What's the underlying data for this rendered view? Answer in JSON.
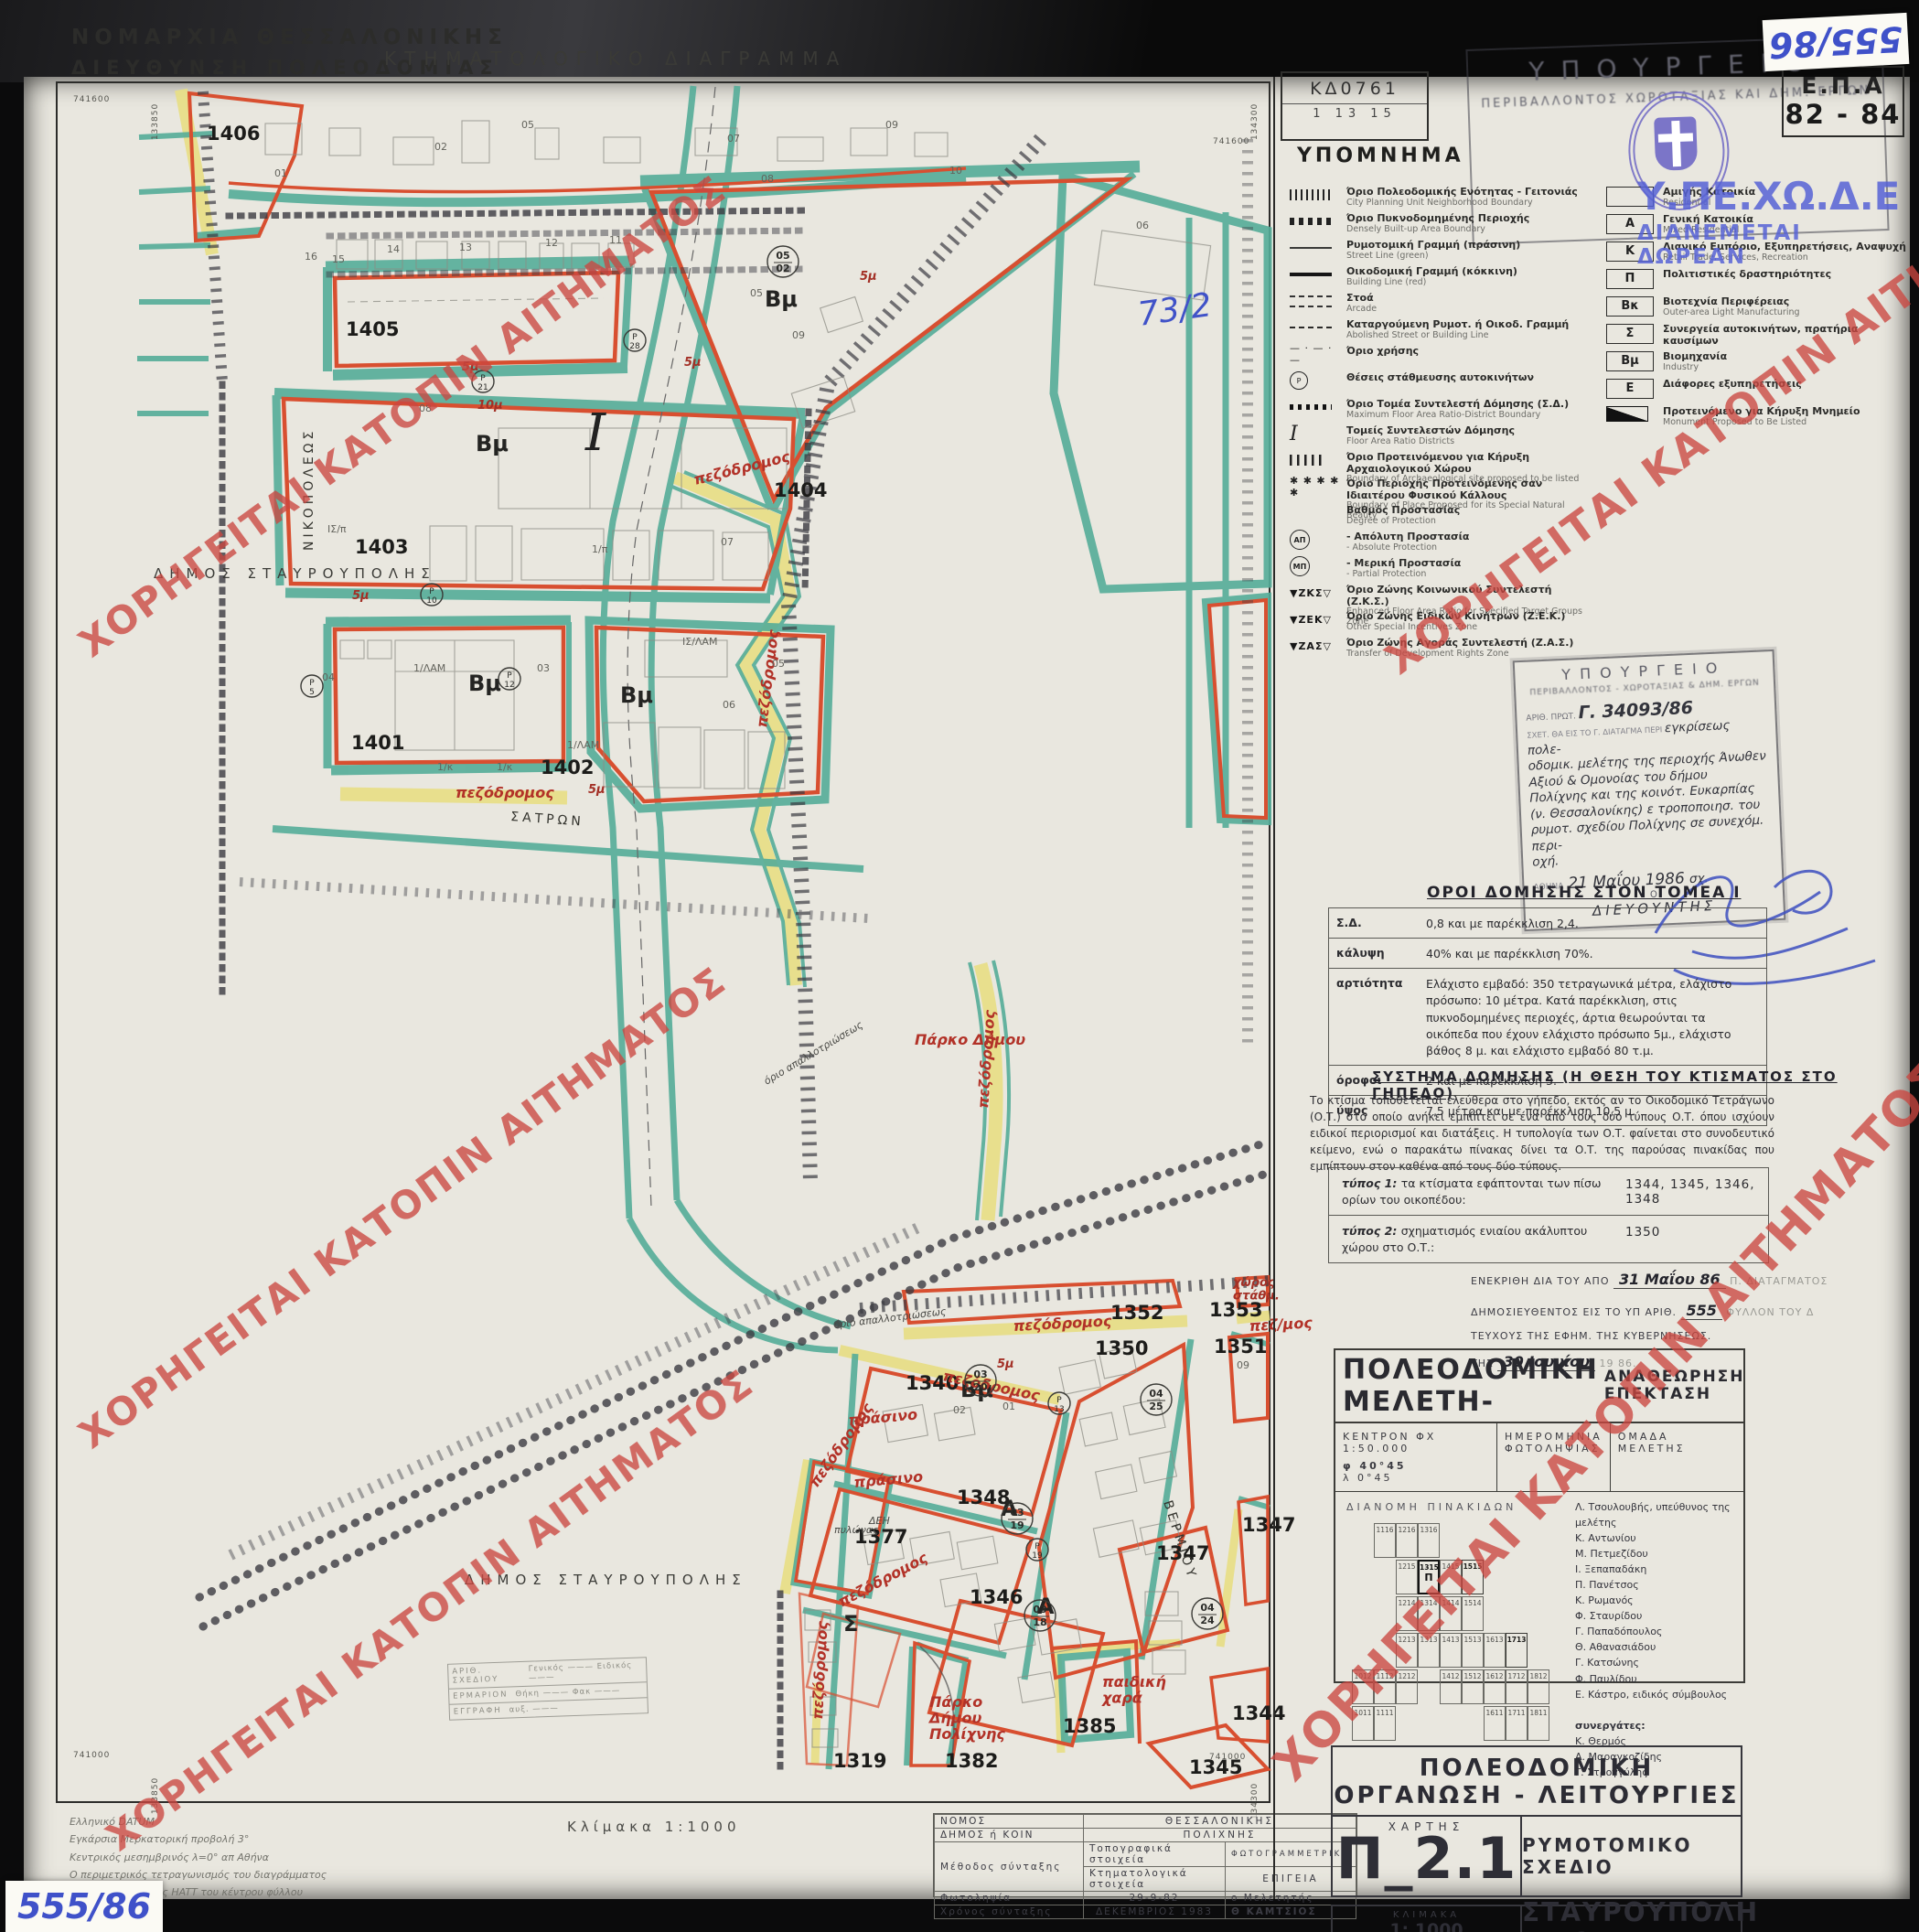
{
  "watermark": {
    "text": "ΧΟΡΗΓΕΙΤΑΙ ΚΑΤΟΠΙΝ ΑΙΤΗΜΑΤΟΣ",
    "color": "#ca4640"
  },
  "header": {
    "org_line1": "ΝΟΜΑΡΧΙΑ ΘΕΣΣΑΛΟΝΙΚΗΣ",
    "org_line2": "ΔΙΕΥΘΥΝΣΗ ΠΟΛΕΟΔΟΜΙΑΣ",
    "title": "ΚΤΗΜΑΤΟΛΟΓΙΚΟ ΔΙΑΓΡΑΜΜΑ",
    "sheet_code": "ΚΔ0761",
    "sheet_index": "1 13 15"
  },
  "stamps": {
    "ministry": {
      "l1": "ΥΠΟΥΡΓΕΙΟ",
      "l2": "ΠΕΡΙΒΑΛΛΟΝΤΟΣ   ΧΩΡΟΤΑΞΙΑΣ   ΚΑΙ   ΔΗΜ.   ΕΡΓΩΝ"
    },
    "overprint1": "Υ.ΠΕ.ΧΩ.Δ.Ε",
    "overprint2": "ΔΙΑΝΕΜΕΤΑΙ ΔΩΡΕΑΝ",
    "epa1": "Ε.Π.Α",
    "epa2": "82 - 84",
    "sticker_top": "555/86",
    "sticker_bottom": "555/86",
    "note_blue": "73/2"
  },
  "approval_stamp": {
    "l1": "ΥΠΟΥΡΓΕΙΟ",
    "l2": "ΠΕΡΙΒΑΛΛΟΝΤΟΣ - ΧΩΡΟΤΑΞΙΑΣ & ΔΗΜ. ΕΡΓΩΝ",
    "prot_label": "ΑΡΙΘ. ΠΡΩΤ.",
    "prot_num": "Γ. 34093/86",
    "rel_line": "ΣΧΕΤ. ΘΑ ΕΙΣ ΤΟ Γ. ΔΙΑΤΑΓΜΑ ΠΕΡΙ",
    "hw_inline": "εγκρίσεως πολε-",
    "hw_lines": [
      "οδομικ. μελέτης της περιοχής Άνωθεν",
      "Αξιού & Ομονοίας του δήμου",
      "Πολίχνης και της κοινότ. Ευκαρπίας",
      "(ν. Θεσσαλονίκης) ε τροποποιησ. του",
      "ρυμοτ. σχεδίου Πολίχνης σε συνεχόμ. περι-",
      "οχή."
    ],
    "city": "ΑΘΗΝΑ",
    "date": "21 Μαΐου 1986",
    "date_suffix": "σχ.",
    "o": "Ο",
    "role": "ΔΙΕΥΘΥΝΤΗΣ"
  },
  "legend": {
    "title": "ΥΠΟΜΝΗΜΑ",
    "items": [
      {
        "sym": "hatch",
        "el": "Όριο Πολεοδομικής Ενότητας - Γειτονιάς",
        "en": "City Planning Unit Neighborhood Boundary"
      },
      {
        "sym": "dotsq",
        "el": "Όριο Πυκνοδομημένης Περιοχής",
        "en": "Densely Built-up Area Boundary"
      },
      {
        "sym": "thin",
        "el": "Ρυμοτομική Γραμμή (πράσινη)",
        "en": "Street Line (green)"
      },
      {
        "sym": "thick",
        "el": "Οικοδομική Γραμμή (κόκκινη)",
        "en": "Building Line (red)"
      },
      {
        "sym": "arcade",
        "el": "Στοά",
        "en": "Arcade"
      },
      {
        "sym": "dashed",
        "el": "Καταργούμενη Ρυμοτ. ή Οικοδ. Γραμμή",
        "en": "Abolished Street or Building Line"
      },
      {
        "sym": "glyph",
        "glyph": "— · — · —",
        "el": "Όριο  χρήσης",
        "en": ""
      },
      {
        "sym": "circ",
        "glyph": "Ρ",
        "el": "Θέσεις στάθμευσης αυτοκινήτων",
        "en": ""
      },
      {
        "sym": "dots",
        "el": "Όριο Τομέα Συντελεστή Δόμησης (Σ.Δ.)",
        "en": "Maximum Floor Area Ratio-District Boundary"
      },
      {
        "sym": "roman",
        "glyph": "I",
        "el": "Τομείς Συντελεστών Δόμησης",
        "en": "Floor Area Ratio Districts"
      },
      {
        "sym": "vbars",
        "el": "Όριο Προτεινόμενου για Κήρυξη Αρχαιολογικού Χώρου",
        "en": "Boundary of Archaeological site proposed to be listed"
      },
      {
        "sym": "glyph",
        "glyph": "✱ ✱ ✱ ✱ ✱",
        "el": "Όριο Περιοχής Προτεινόμενης σαν Ιδιαιτέρου Φυσικού Κάλλους",
        "en": "Boundary of Place Proposed for its Special Natural Beauty"
      },
      {
        "sym": "none",
        "el": "Βαθμός Προστασίας",
        "en": "Degree of Protection"
      },
      {
        "sym": "badge",
        "glyph": "ΑΠ",
        "el": "-  Απόλυτη Προστασία",
        "en": "-  Absolute Protection"
      },
      {
        "sym": "badge",
        "glyph": "ΜΠ",
        "el": "-  Μερική Προστασία",
        "en": "-  Partial Protection"
      },
      {
        "sym": "zone",
        "glyph": "▼ΖΚΣ▽",
        "el": "Όριο Ζώνης Κοινωνικού Συντελεστή (Ζ.Κ.Σ.)",
        "en": "Enhanced Floor Area Ratio for Specified Target Groups Zone"
      },
      {
        "sym": "zone",
        "glyph": "▼ΖΕΚ▽",
        "el": "Όριο Ζώνης Ειδικών Κινήτρων (Ζ.Ε.Κ.)",
        "en": "Other Special Incentives Zone"
      },
      {
        "sym": "zone",
        "glyph": "▼ΖΑΣ▽",
        "el": "Όριο Ζώνης Αγοράς Συντελεστή (Ζ.Α.Σ.)",
        "en": "Transfer of Development Rights Zone"
      }
    ],
    "uses": [
      {
        "code": "",
        "el": "Αμιγής Κατοικία",
        "en": "Residential"
      },
      {
        "code": "Α",
        "el": "Γενική Κατοικία",
        "en": "Mixed Residential"
      },
      {
        "code": "Κ",
        "el": "Λιανικό Εμπόριο, Εξυπηρετήσεις, Αναψυχή",
        "en": "Retail Trade, Services, Recreation"
      },
      {
        "code": "Π",
        "el": "Πολιτιστικές δραστηριότητες",
        "en": ""
      },
      {
        "code": "Βκ",
        "el": "Βιοτεχνία Περιφέρειας",
        "en": "Outer-area Light Manufacturing"
      },
      {
        "code": "Σ",
        "el": "Συνεργεία αυτοκινήτων, πρατήρια καυσίμων",
        "en": ""
      },
      {
        "code": "Βμ",
        "el": "Βιομηχανία",
        "en": "Industry"
      },
      {
        "code": "Ε",
        "el": "Διάφορες εξυπηρετήσεις",
        "en": ""
      },
      {
        "code": "MONO",
        "el": "Προτεινόμενο για Κήρυξη Μνημείο",
        "en": "Monument Proposed to Be Listed"
      }
    ]
  },
  "terms": {
    "title": "ΟΡΟΙ ΔΟΜΗΣΗΣ ΣΤΟΝ ΤΟΜΕΑ Ι",
    "rows": [
      {
        "label": "Σ.Δ.",
        "value": "0,8 και με παρέκκλιση 2,4."
      },
      {
        "label": "κάλυψη",
        "value": "40% και με παρέκκλιση 70%."
      },
      {
        "label": "αρτιότητα",
        "value": "Ελάχιστο εμβαδό: 350 τετραγωνικά μέτρα, ελάχιστο πρόσωπο: 10 μέτρα.  Κατά παρέκκλιση, στις πυκνοδομημένες περιοχές, άρτια θεωρούνται τα οικόπεδα που έχουν ελάχιστο πρόσωπο 5μ., ελάχιστο βάθος 8 μ. και ελάχιστο εμβαδό 80 τ.μ."
      },
      {
        "label": "όροφοι",
        "value": "2 και με παρέκκλιση 3."
      },
      {
        "label": "ύψος",
        "value": "7,5 μέτρα και με παρέκκλιση 10,5 μ."
      }
    ]
  },
  "system": {
    "title": "ΣΥΣΤΗΜΑ ΔΟΜΗΣΗΣ (Η ΘΕΣΗ ΤΟΥ ΚΤΙΣΜΑΤΟΣ ΣΤΟ ΓΗΠΕΔΟ)",
    "paragraph": "Το κτίσμα τοποθετείται ελεύθερα στο γήπεδο, εκτός αν το Οικοδομικό Τετράγωνο (Ο.Τ.) στο οποίο ανήκει εμπίπτει σε ένα από τους δύο τύπους Ο.Τ. όπου ισχύουν ειδικοί περιορισμοί και διατάξεις.  Η τυπολογία των Ο.Τ. φαίνεται στο συνοδευτικό κείμενο, ενώ ο παρακάτω πίνακας δίνει τα Ο.Τ. της παρούσας πινακίδας που εμπίπτουν στον καθένα από τους δύο τύπους.",
    "types": [
      {
        "label": "τύπος 1:",
        "desc": "τα κτίσματα εφάπτονται των πίσω ορίων του οικοπέδου:",
        "blocks": "1344, 1345, 1346, 1348"
      },
      {
        "label": "τύπος 2:",
        "desc": "σχηματισμός ενιαίου ακάλυπτου χώρου στο Ο.Τ.:",
        "blocks": "1350"
      }
    ]
  },
  "gazette": {
    "lines": [
      {
        "p": "ΕΝΕΚΡΙΘΗ ΔΙΑ ΤΟΥ ΑΠΟ",
        "h": "31 Μαΐου 86",
        "f": "Π. ΔΙΑΤΑΓΜΑΤΟΣ"
      },
      {
        "p": "ΔΗΜΟΣΙΕΥΘΕΝΤΟΣ ΕΙΣ ΤΟ ΥΠ ΑΡΙΘ.",
        "h": "555",
        "f": "ΦΥΛΛΟΝ ΤΟΥ Δ"
      },
      {
        "p": "ΤΕΥΧΟΥΣ ΤΗΣ ΕΦΗΜ. ΤΗΣ ΚΥΒΕΡΝΗΣΕΩΣ.",
        "h": "",
        "f": ""
      },
      {
        "p": "ΤΗΣ",
        "h": "30 Ιουνίου",
        "f": "19 86."
      }
    ]
  },
  "study": {
    "title_main": "ΠΟΛΕΟΔΟΜΙΚΗ ΜΕΛΕΤΗ-",
    "title_sub1": "ΑΝΑΘΕΩΡΗΣΗ",
    "title_sub2": "ΕΠΕΚΤΑΣΗ",
    "kentron_l1": "ΚΕΝΤΡΟΝ ΦΧ 1:50.000",
    "kentron_l2": "φ  40°45",
    "kentron_l3": "λ   0°45",
    "photo_l1": "ΗΜΕΡΟΜΗΝΙΑ",
    "photo_l2": "ΦΩΤΟΛΗΨΙΑΣ",
    "team_title": "ΟΜΑΔΑ  ΜΕΛΕΤΗΣ",
    "team": [
      "Λ. Τσουλουβής, υπεύθυνος της μελέτης",
      "Κ. Αντωνίου",
      "Μ. Πετμεζίδου",
      "Ι. Ξεπαπαδάκη",
      "Π. Πανέτσος",
      "Κ. Ρωμανός",
      "Φ. Σταυρίδου",
      "Γ. Παπαδόπουλος",
      "Θ. Αθανασιάδου",
      "Γ. Κατσώνης",
      "Φ. Παυλίδου",
      "Ε. Κάστρο, ειδικός σύμβουλος"
    ],
    "collab_title": "συνεργάτες:",
    "collaborators": [
      "Κ. Θερμός",
      "Α. Μαραγκοζίδης",
      "Γ. Στρογγύλης"
    ],
    "grid_title": "ΔΙΑΝΟΜΗ  ΠΙΝΑΚΙΔΩΝ",
    "grid_cells": [
      {
        "n": "1116",
        "c": 1,
        "r": 0
      },
      {
        "n": "1216",
        "c": 2,
        "r": 0
      },
      {
        "n": "1316",
        "c": 3,
        "r": 0
      },
      {
        "n": "1215",
        "c": 2,
        "r": 1
      },
      {
        "n": "1315",
        "c": 3,
        "r": 1,
        "cur": true,
        "sub": "Π"
      },
      {
        "n": "1415",
        "c": 4,
        "r": 1
      },
      {
        "n": "1515",
        "c": 5,
        "r": 1,
        "b": true
      },
      {
        "n": "1214",
        "c": 2,
        "r": 2
      },
      {
        "n": "1314",
        "c": 3,
        "r": 2
      },
      {
        "n": "1414",
        "c": 4,
        "r": 2
      },
      {
        "n": "1514",
        "c": 5,
        "r": 2
      },
      {
        "n": "1213",
        "c": 2,
        "r": 3
      },
      {
        "n": "1313",
        "c": 3,
        "r": 3
      },
      {
        "n": "1413",
        "c": 4,
        "r": 3
      },
      {
        "n": "1513",
        "c": 5,
        "r": 3
      },
      {
        "n": "1613",
        "c": 6,
        "r": 3
      },
      {
        "n": "1713",
        "c": 7,
        "r": 3,
        "b": true
      },
      {
        "n": "1012",
        "c": 0,
        "r": 4
      },
      {
        "n": "1112",
        "c": 1,
        "r": 4
      },
      {
        "n": "1212",
        "c": 2,
        "r": 4
      },
      {
        "n": "1412",
        "c": 4,
        "r": 4
      },
      {
        "n": "1512",
        "c": 5,
        "r": 4
      },
      {
        "n": "1612",
        "c": 6,
        "r": 4
      },
      {
        "n": "1712",
        "c": 7,
        "r": 4
      },
      {
        "n": "1812",
        "c": 8,
        "r": 4
      },
      {
        "n": "1011",
        "c": 0,
        "r": 5
      },
      {
        "n": "1111",
        "c": 1,
        "r": 5
      },
      {
        "n": "1611",
        "c": 6,
        "r": 5
      },
      {
        "n": "1711",
        "c": 7,
        "r": 5
      },
      {
        "n": "1811",
        "c": 8,
        "r": 5
      }
    ]
  },
  "org": {
    "title": "ΠΟΛΕΟΔΟΜΙΚΗ  ΟΡΓΑΝΩΣΗ - ΛΕΙΤΟΥΡΓΙΕΣ",
    "chart_label": "ΧΑΡΤΗΣ",
    "chart_code": "Π_2.1",
    "map_type": "ΡΥΜΟΤΟΜΙΚΟ ΣΧΕΔΙΟ",
    "scale_label": "ΚΛΙΜΑΚΑ",
    "scale": "1: 1000",
    "date": "ΓΕΝΑΡΗΣ 1986",
    "area": "ΣΤΑΥΡΟΥΠΟΛΗ – ΠΟΛΙΧΝΗ",
    "nomos_label": "ΝΟΜΟΣ",
    "nomos": "ΘΕΣΣΑΛΟΝΙΚΗΣ"
  },
  "title_block": {
    "nomos_label": "ΝΟΜΟΣ",
    "nomos": "ΘΕΣΣΑΛΟΝΙΚΗΣ",
    "dimos_label": "ΔΗΜΟΣ ή ΚΟΙΝ",
    "dimos": "ΠΟΛΙΧΝΗΣ",
    "method_label": "Μέθοδος σύνταξης",
    "topo_label": "Τοπογραφικά στοιχεία",
    "topo": "ΦΩΤΟΓΡΑΜΜΕΤΡΙΚΑ",
    "ktim_label": "Κτηματολογικά στοιχεία",
    "ktim": "ΕΠΙΓΕΙΑ",
    "photo_label": "Φωτοληψία",
    "photo": "29-9-82",
    "meletitis_label": "ο Μελετητής",
    "time_label": "Χρόνος σύνταξης",
    "time": "ΔΕΚΕΜΒΡΙΟΣ 1983",
    "meletitis": "Θ ΚΑΜΤΣΙΟΣ"
  },
  "datum_notes": [
    "Ελληνικό DATUM",
    "Εγκάρσια Μερκατορική προβολή 3°",
    "Κεντρικός μεσημβρινός λ=0° απ Αθήνα",
    "Ο περιμετρικός τετραγωνισμός του διαγράμματος",
    "είναι της προβολής HATT του κέντρου φύλλου",
    "απ Αθήνα"
  ],
  "scale_note": "Κλίμακα  1:1000",
  "archive": {
    "r1l": "ΑΡΙΘ. ΣΧΕΔΙΟΥ",
    "r1v": "Γενικός ———   Ειδικός ———",
    "r2l": "ΕΡΜΑΡΙΟΝ",
    "r2v": "Θήκη ———   Φακ ———",
    "r3l": "ΕΓΓΡΑΦΗ",
    "r3v": "αυξ. ———"
  },
  "map": {
    "corners": {
      "tl_e": "741600",
      "tl_n": "133850",
      "tr_e": "741600",
      "tr_n": "134300",
      "bl_e": "741000",
      "bl_n": "133850",
      "br_e": "741000",
      "br_n": "134300"
    },
    "labels": [
      [
        "1406",
        226,
        153,
        "bn"
      ],
      [
        "1405",
        378,
        367,
        "bn"
      ],
      [
        "1403",
        388,
        605,
        "bn"
      ],
      [
        "1401",
        384,
        819,
        "bn"
      ],
      [
        "1402",
        591,
        846,
        "bn"
      ],
      [
        "1404",
        846,
        543,
        "bn"
      ],
      [
        "1340",
        990,
        1519,
        "bn"
      ],
      [
        "1350",
        1197,
        1481,
        "bn"
      ],
      [
        "1351",
        1327,
        1479,
        "bn"
      ],
      [
        "1352",
        1214,
        1442,
        "bn"
      ],
      [
        "1353",
        1322,
        1439,
        "bn"
      ],
      [
        "1348",
        1046,
        1644,
        "bn"
      ],
      [
        "1377",
        934,
        1687,
        "bn"
      ],
      [
        "1346",
        1060,
        1753,
        "bn"
      ],
      [
        "1347",
        1264,
        1705,
        "bn"
      ],
      [
        "1347",
        1358,
        1674,
        "bn"
      ],
      [
        "1319",
        911,
        1932,
        "bn"
      ],
      [
        "1382",
        1033,
        1932,
        "bn"
      ],
      [
        "1385",
        1162,
        1894,
        "bn"
      ],
      [
        "1345",
        1300,
        1939,
        "bn"
      ],
      [
        "1344",
        1347,
        1880,
        "bn"
      ],
      [
        "Βμ",
        520,
        493,
        "zn"
      ],
      [
        "Βμ",
        512,
        755,
        "zn"
      ],
      [
        "Βμ",
        678,
        768,
        "zn"
      ],
      [
        "Βμ",
        836,
        335,
        "zn"
      ],
      [
        "Βμ",
        1050,
        1527,
        "zn"
      ],
      [
        "Α",
        1094,
        1657,
        "zn"
      ],
      [
        "Α",
        1134,
        1764,
        "zn"
      ],
      [
        "Σ",
        922,
        1783,
        "zn"
      ],
      [
        "Ι",
        640,
        492,
        "far"
      ],
      [
        "ΝΙΚΟΠΟΛΕΩΣ",
        342,
        602,
        "st",
        -90
      ],
      [
        "ΣΑΤΡΩΝ",
        558,
        897,
        "st",
        4
      ],
      [
        "ΒΕΡΜΙΟΥ",
        1272,
        1642,
        "st",
        72
      ],
      [
        "ΔΗΜΟΣ  ΣΤΑΥΡΟΥΠΟΛΗΣ",
        168,
        632,
        "mu"
      ],
      [
        "ΔΗΜΟΣ  ΣΤΑΥΡΟΥΠΟΛΗΣ",
        508,
        1732,
        "mu"
      ],
      [
        "Πάρκο Δήμου",
        1000,
        1142,
        "hw"
      ],
      [
        "Πάρκο\nΔήμου\nΠολίχνης",
        1016,
        1866,
        "hw"
      ],
      [
        "παιδική\nχαρά",
        1205,
        1844,
        "hw"
      ],
      [
        "πράσινο",
        928,
        1558,
        "hw",
        -5
      ],
      [
        "πράσινο",
        934,
        1626,
        "hw",
        -5
      ],
      [
        "πεζόδρομος",
        498,
        872,
        "hw"
      ],
      [
        "πεζόδρομος",
        760,
        530,
        "hw",
        -14
      ],
      [
        "πεζόδρομος",
        838,
        796,
        "hw",
        -83
      ],
      [
        "πεζόδρομος",
        1080,
        1212,
        "hw",
        -86
      ],
      [
        "πεζόδρομος",
        1108,
        1455,
        "hw",
        -3
      ],
      [
        "πεζόδρομος",
        1030,
        1509,
        "hw",
        12
      ],
      [
        "πεζόδρομος",
        893,
        1627,
        "hw",
        -55
      ],
      [
        "πεζόδρομος",
        920,
        1757,
        "hw",
        -28
      ],
      [
        "πεζόδρομος",
        899,
        1880,
        "hw",
        -87
      ],
      [
        "πεζ/μος",
        1366,
        1455,
        "hw",
        -3
      ],
      [
        "χώρος\nστάθμ.",
        1348,
        1406,
        "hws"
      ],
      [
        "5μ",
        505,
        405,
        "hws"
      ],
      [
        "5μ",
        748,
        400,
        "hws"
      ],
      [
        "5μ",
        385,
        655,
        "hws"
      ],
      [
        "5μ",
        643,
        867,
        "hws"
      ],
      [
        "5μ",
        1090,
        1495,
        "hws"
      ],
      [
        "10μ",
        522,
        447,
        "hws"
      ],
      [
        "5μ",
        940,
        306,
        "hws"
      ],
      [
        "όριο απαλλοτριώσεως",
        912,
        1452,
        "tn",
        -7
      ],
      [
        "όριο απαλλοτριώσεως",
        838,
        1186,
        "tn",
        -31
      ],
      [
        "ΔΕΗ",
        950,
        1666,
        "tn"
      ],
      [
        "πυλώνας",
        912,
        1676,
        "tn"
      ],
      [
        "01",
        300,
        193,
        "pt"
      ],
      [
        "02",
        475,
        164,
        "pt"
      ],
      [
        "05",
        570,
        140,
        "pt"
      ],
      [
        "07",
        795,
        155,
        "pt"
      ],
      [
        "09",
        968,
        140,
        "pt"
      ],
      [
        "08",
        832,
        199,
        "pt"
      ],
      [
        "10",
        1038,
        190,
        "pt"
      ],
      [
        "16",
        333,
        284,
        "pt"
      ],
      [
        "15",
        363,
        287,
        "pt"
      ],
      [
        "14",
        423,
        276,
        "pt"
      ],
      [
        "13",
        502,
        274,
        "pt"
      ],
      [
        "12",
        596,
        269,
        "pt"
      ],
      [
        "11",
        666,
        266,
        "pt"
      ],
      [
        "09",
        866,
        370,
        "pt"
      ],
      [
        "08",
        458,
        450,
        "pt"
      ],
      [
        "07",
        788,
        596,
        "pt"
      ],
      [
        "05",
        820,
        324,
        "pt"
      ],
      [
        "06",
        1242,
        250,
        "pt"
      ],
      [
        "06",
        790,
        774,
        "pt"
      ],
      [
        "05",
        844,
        729,
        "pt"
      ],
      [
        "04",
        352,
        744,
        "pt"
      ],
      [
        "03",
        587,
        734,
        "pt"
      ],
      [
        "02",
        1042,
        1545,
        "pt"
      ],
      [
        "01",
        1096,
        1541,
        "pt"
      ],
      [
        "09",
        1352,
        1496,
        "pt"
      ],
      [
        "1/ΛΑΜ",
        452,
        734,
        "pt"
      ],
      [
        "1/κ",
        478,
        842,
        "pt"
      ],
      [
        "1/κ",
        543,
        842,
        "pt"
      ],
      [
        "ΙΣ/ΛΑΜ",
        746,
        705,
        "pt"
      ],
      [
        "1/ΛΑΜ",
        620,
        818,
        "pt"
      ],
      [
        "1/π",
        647,
        604,
        "pt"
      ],
      [
        "ΙΣ/π",
        358,
        582,
        "pt"
      ],
      [
        "05|02",
        856,
        286,
        "fr"
      ],
      [
        "03|20",
        1072,
        1509,
        "fr"
      ],
      [
        "03|19",
        1112,
        1660,
        "fr"
      ],
      [
        "03|18",
        1137,
        1766,
        "fr"
      ],
      [
        "04|25",
        1264,
        1530,
        "fr"
      ],
      [
        "04|24",
        1320,
        1764,
        "fr"
      ],
      [
        "Ρ|5",
        341,
        750,
        "pk"
      ],
      [
        "Ρ|10",
        472,
        650,
        "pk"
      ],
      [
        "Ρ|12",
        557,
        742,
        "pk"
      ],
      [
        "Ρ|21",
        528,
        417,
        "pk"
      ],
      [
        "Ρ|28",
        694,
        372,
        "pk"
      ],
      [
        "Ρ|13",
        1158,
        1534,
        "pk"
      ],
      [
        "Ρ|19",
        1134,
        1694,
        "pk"
      ],
      [
        "73/2",
        1246,
        356,
        "ink",
        -8
      ]
    ]
  }
}
